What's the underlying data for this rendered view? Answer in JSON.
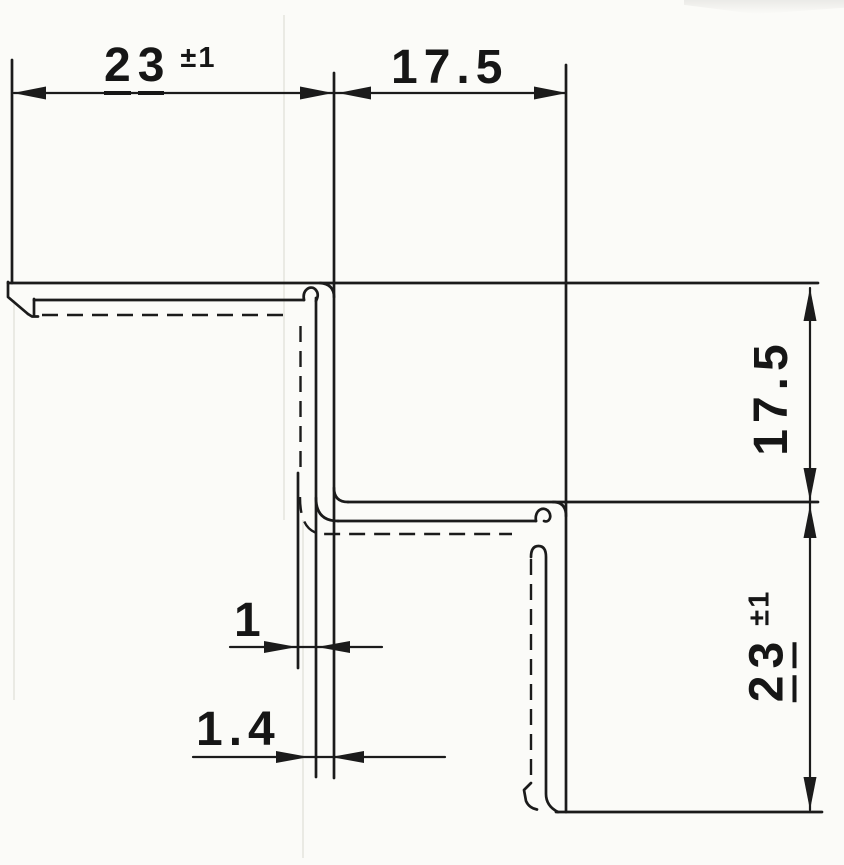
{
  "drawing": {
    "type": "technical-cross-section",
    "description": "Scanned dimensioned cross-section of a stepped sheet-metal corner profile with hemmed edges",
    "ink_color": "#1b1b1b",
    "paper_color": "#fbfbf8",
    "dimensions": {
      "top_flange_width": {
        "value": "23",
        "tolerance": "±1"
      },
      "top_step_width": {
        "value": "17.5",
        "tolerance": ""
      },
      "right_step_height": {
        "value": "17.5",
        "tolerance": ""
      },
      "bottom_flange_height": {
        "value": "23",
        "tolerance": "±1"
      },
      "sheet_thickness": {
        "value": "1",
        "tolerance": ""
      },
      "hem_thickness": {
        "value": "1.4",
        "tolerance": ""
      }
    }
  }
}
